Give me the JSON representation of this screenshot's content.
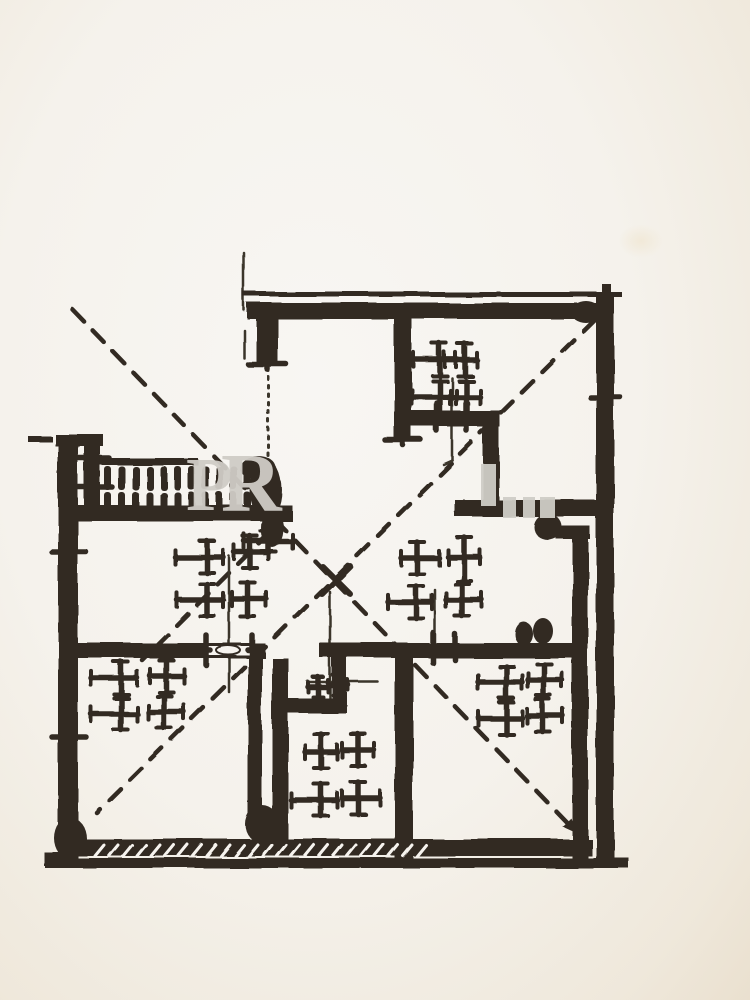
{
  "meta": {
    "kind": "scanned hand-drawn floor plan, black ink on cream paper, no labels"
  },
  "palette": {
    "ink": "#322b24",
    "ink_soft": "#3a342c",
    "paper": "#f6f3ee",
    "paper_shadow": "#ece2d2",
    "watermark_gray": "#cfccc6",
    "stain": "#f1e9d8"
  },
  "watermark": {
    "letters": [
      {
        "ch": "P",
        "x": 186,
        "y": 456,
        "size": 76
      },
      {
        "ch": "R",
        "x": 221,
        "y": 451,
        "size": 84
      }
    ],
    "fragments": [
      {
        "x": 481,
        "y": 464,
        "w": 15,
        "h": 42
      },
      {
        "x": 503,
        "y": 497,
        "w": 13,
        "h": 21
      },
      {
        "x": 523,
        "y": 497,
        "w": 12,
        "h": 21
      },
      {
        "x": 540,
        "y": 497,
        "w": 15,
        "h": 21
      }
    ]
  },
  "stain": {
    "x": 618,
    "y": 224,
    "w": 46,
    "h": 34
  },
  "plan": {
    "walls": [
      {
        "n": "top-thin-line",
        "r": [
          243,
          292,
          379,
          5
        ]
      },
      {
        "n": "top-wall",
        "r": [
          247,
          303,
          366,
          16
        ]
      },
      {
        "n": "right-wall",
        "r": [
          596,
          295,
          18,
          570
        ]
      },
      {
        "n": "right-wall-stub",
        "r": [
          602,
          284,
          9,
          22
        ]
      },
      {
        "n": "topleft-wall",
        "r": [
          256,
          316,
          22,
          50
        ]
      },
      {
        "n": "wall-a",
        "r": [
          394,
          316,
          18,
          126
        ]
      },
      {
        "n": "wall-b",
        "r": [
          404,
          411,
          96,
          16
        ]
      },
      {
        "n": "wall-c",
        "r": [
          483,
          425,
          16,
          82
        ]
      },
      {
        "n": "wall-d",
        "r": [
          455,
          500,
          145,
          17
        ]
      },
      {
        "n": "wall-d-jog",
        "r": [
          556,
          526,
          34,
          13
        ]
      },
      {
        "n": "wall-e",
        "r": [
          572,
          526,
          16,
          332
        ]
      },
      {
        "n": "left-wall",
        "r": [
          58,
          437,
          20,
          428
        ]
      },
      {
        "n": "left-wall-cap",
        "r": [
          55,
          434,
          48,
          12
        ]
      },
      {
        "n": "left-stray-dash",
        "r": [
          28,
          436,
          24,
          6
        ]
      },
      {
        "n": "railing-post",
        "r": [
          84,
          443,
          16,
          66
        ]
      },
      {
        "n": "railing-top-rail",
        "r": [
          90,
          458,
          108,
          7
        ]
      },
      {
        "n": "railing-bottom-rail",
        "r": [
          62,
          505,
          230,
          16
        ]
      },
      {
        "n": "mid-wall-left",
        "r": [
          62,
          643,
          203,
          15
        ]
      },
      {
        "n": "mid-wall-right",
        "r": [
          320,
          643,
          263,
          15
        ]
      },
      {
        "n": "wall-g",
        "r": [
          248,
          658,
          14,
          168
        ]
      },
      {
        "n": "wall-h",
        "r": [
          272,
          658,
          16,
          185
        ]
      },
      {
        "n": "bath-top-wall",
        "r": [
          275,
          698,
          72,
          15
        ]
      },
      {
        "n": "bath-step-wall",
        "r": [
          332,
          658,
          15,
          48
        ]
      },
      {
        "n": "wall-i",
        "r": [
          395,
          643,
          18,
          215
        ]
      },
      {
        "n": "bottom-wall",
        "r": [
          62,
          839,
          530,
          17
        ]
      },
      {
        "n": "bottom-outer-line",
        "r": [
          45,
          858,
          583,
          10
        ]
      },
      {
        "n": "left-wall-foot",
        "r": [
          44,
          852,
          20,
          14
        ]
      },
      {
        "n": "right-wall-foot",
        "r": [
          612,
          857,
          16,
          11
        ]
      }
    ],
    "gaps": [
      {
        "n": "window-gap-left-midwall",
        "r": [
          208,
          646,
          42,
          9
        ]
      }
    ],
    "thin_lines": [
      {
        "n": "construction-line-topleft",
        "p": [
          244,
          253,
          244,
          310
        ]
      },
      {
        "n": "construction-line-topleft2",
        "p": [
          244,
          330,
          244,
          358
        ]
      },
      {
        "n": "terrace-edge-dotted",
        "p": [
          268,
          368,
          268,
          458
        ],
        "dot": true
      },
      {
        "n": "sketch-line-tr-room",
        "p": [
          452,
          378,
          452,
          460
        ]
      },
      {
        "n": "sketch-line-tr-hook",
        "p": [
          452,
          460,
          443,
          464
        ]
      },
      {
        "n": "sketch-line-hall-left",
        "p": [
          229,
          556,
          229,
          692
        ]
      },
      {
        "n": "sketch-line-hall-right",
        "p": [
          435,
          590,
          435,
          652
        ]
      },
      {
        "n": "bath-door-leaf-vertical",
        "p": [
          330,
          592,
          330,
          700
        ]
      },
      {
        "n": "bath-door-leaf-horizontal",
        "p": [
          308,
          682,
          378,
          682
        ]
      }
    ],
    "dashed_lines": [
      {
        "n": "diagonal-cross-a",
        "p": [
          73,
          310,
          577,
          833
        ],
        "arrow_end": true
      },
      {
        "n": "diagonal-cross-b",
        "p": [
          595,
          320,
          97,
          813
        ],
        "arrow_end": false
      },
      {
        "n": "door-swing-dashed",
        "p": [
          270,
          532,
          142,
          660
        ],
        "arrow_end": false
      }
    ],
    "x_marks": [
      {
        "n": "center-arrow-stroke",
        "p": [
          322,
          566,
          350,
          594
        ]
      },
      {
        "n": "center-arrow-stroke",
        "p": [
          350,
          566,
          322,
          594
        ]
      }
    ],
    "crosses": [
      {
        "x": 440,
        "y": 360,
        "o": {
          "l": 26
        }
      },
      {
        "x": 465,
        "y": 360,
        "o": {
          "l": 20,
          "r": 12
        }
      },
      {
        "x": 440,
        "y": 397,
        "o": {
          "l": 28,
          "d": 16
        }
      },
      {
        "x": 466,
        "y": 397,
        "o": {
          "r": 14,
          "d": 20
        }
      },
      {
        "x": 437,
        "y": 417,
        "o": {
          "l": 5,
          "r": 5,
          "u": 14,
          "d": 14,
          "t": 0
        }
      },
      {
        "x": 467,
        "y": 417,
        "o": {
          "l": 5,
          "r": 5,
          "u": 14,
          "d": 14,
          "t": 0
        }
      },
      {
        "x": 207,
        "y": 557,
        "o": {
          "l": 32
        }
      },
      {
        "x": 250,
        "y": 552,
        "o": {
          "r": 18
        }
      },
      {
        "x": 207,
        "y": 600,
        "o": {
          "l": 30
        }
      },
      {
        "x": 248,
        "y": 599,
        "o": {
          "r": 18,
          "d": 18
        }
      },
      {
        "x": 417,
        "y": 558,
        "o": {
          "r": 22
        }
      },
      {
        "x": 464,
        "y": 557,
        "o": {
          "u": 20,
          "d": 24
        }
      },
      {
        "x": 416,
        "y": 602,
        "o": {
          "l": 28
        }
      },
      {
        "x": 462,
        "y": 600,
        "o": {
          "r": 20
        }
      },
      {
        "x": 121,
        "y": 678,
        "o": {
          "l": 30
        }
      },
      {
        "x": 166,
        "y": 676,
        "o": {
          "r": 18
        }
      },
      {
        "x": 121,
        "y": 714,
        "o": {
          "l": 30,
          "d": 16
        }
      },
      {
        "x": 164,
        "y": 712,
        "o": {
          "r": 20,
          "d": 16
        }
      },
      {
        "x": 321,
        "y": 752,
        "o": {
          "u": 18
        }
      },
      {
        "x": 358,
        "y": 750,
        "o": {
          "r": 16,
          "u": 16
        }
      },
      {
        "x": 321,
        "y": 800,
        "o": {
          "l": 30,
          "d": 16
        }
      },
      {
        "x": 358,
        "y": 798,
        "o": {
          "r": 22,
          "d": 16
        }
      },
      {
        "x": 506,
        "y": 682,
        "o": {
          "l": 28,
          "u": 16
        }
      },
      {
        "x": 544,
        "y": 680,
        "o": {
          "r": 18,
          "u": 16
        }
      },
      {
        "x": 506,
        "y": 718,
        "o": {
          "l": 28,
          "d": 16
        }
      },
      {
        "x": 543,
        "y": 716,
        "o": {
          "r": 20,
          "d": 16
        }
      },
      {
        "x": 318,
        "y": 687,
        "o": {
          "l": 10,
          "r": 10,
          "u": 10,
          "d": 10,
          "t": 7
        }
      },
      {
        "x": 338,
        "y": 685,
        "o": {
          "l": 10,
          "r": 10,
          "u": 10,
          "d": 10,
          "t": 7
        }
      },
      {
        "x": 268,
        "y": 541,
        "o": {
          "l": 24,
          "r": 24,
          "u": 10,
          "d": 10
        }
      },
      {
        "x": 433,
        "y": 648,
        "o": {
          "l": 4,
          "r": 4,
          "u": 15,
          "d": 15,
          "t": 0
        }
      },
      {
        "x": 455,
        "y": 647,
        "o": {
          "l": 4,
          "r": 4,
          "u": 13,
          "d": 13,
          "t": 0
        }
      },
      {
        "x": 206,
        "y": 650,
        "o": {
          "l": 4,
          "r": 4,
          "u": 15,
          "d": 15,
          "t": 0
        }
      },
      {
        "x": 252,
        "y": 650,
        "o": {
          "l": 4,
          "r": 4,
          "u": 15,
          "d": 15,
          "t": 0
        }
      },
      {
        "x": 69,
        "y": 552,
        "o": {
          "l": 17,
          "r": 17,
          "u": 4,
          "d": 4,
          "t": 0
        }
      },
      {
        "x": 69,
        "y": 737,
        "o": {
          "l": 17,
          "r": 17,
          "u": 4,
          "d": 4,
          "t": 0
        }
      },
      {
        "x": 605,
        "y": 397,
        "o": {
          "l": 15,
          "r": 15,
          "u": 4,
          "d": 4,
          "t": 0
        }
      },
      {
        "x": 403,
        "y": 440,
        "o": {
          "l": 18,
          "r": 18,
          "u": 5,
          "d": 5,
          "t": 0
        }
      },
      {
        "x": 267,
        "y": 364,
        "o": {
          "l": 19,
          "r": 19,
          "u": 5,
          "d": 5,
          "t": 0
        }
      },
      {
        "x": 93,
        "y": 458,
        "o": {
          "l": 16,
          "r": 16,
          "u": 4,
          "d": 4,
          "t": 0
        }
      },
      {
        "x": 93,
        "y": 487,
        "o": {
          "l": 19,
          "r": 19,
          "u": 4,
          "d": 4,
          "t": 0
        }
      }
    ],
    "balusters": {
      "x0": 104,
      "step": 14,
      "count": 11,
      "w": 7,
      "rows": [
        {
          "y": 466,
          "h": 24
        },
        {
          "y": 492,
          "h": 18
        }
      ]
    },
    "nicks": {
      "x0": 95,
      "x1": 420,
      "step": 14,
      "y1": 856,
      "y2": 845,
      "dx": 9
    },
    "hatch_ticks": [
      {
        "p": [
          456,
          512,
          464,
          501
        ]
      },
      {
        "p": [
          465,
          513,
          473,
          502
        ]
      }
    ],
    "lens": {
      "cx": 228,
      "cy": 650,
      "rx": 12,
      "ry": 4.5
    },
    "blobs": [
      {
        "n": "door-pivot-terrace",
        "cx": 266,
        "cy": 490,
        "rx": 16,
        "ry": 30
      },
      {
        "n": "door-pivot-terrace-tail",
        "cx": 272,
        "cy": 528,
        "rx": 11,
        "ry": 19
      },
      {
        "n": "door-pivot-terrace-cap",
        "cx": 258,
        "cy": 468,
        "rx": 18,
        "ry": 12
      },
      {
        "n": "door-pivot-bottomleft",
        "cx": 262,
        "cy": 824,
        "rx": 17,
        "ry": 19
      },
      {
        "n": "midwall-blob-1",
        "cx": 524,
        "cy": 634,
        "rx": 9,
        "ry": 12
      },
      {
        "n": "midwall-blob-2",
        "cx": 543,
        "cy": 631,
        "rx": 10,
        "ry": 13
      },
      {
        "n": "wall-d-stub-blob",
        "cx": 548,
        "cy": 527,
        "rx": 14,
        "ry": 13
      },
      {
        "n": "corner-blob-topright",
        "cx": 586,
        "cy": 312,
        "rx": 15,
        "ry": 11
      },
      {
        "n": "corner-blob-bottomleft",
        "cx": 70,
        "cy": 838,
        "rx": 16,
        "ry": 21
      }
    ]
  }
}
